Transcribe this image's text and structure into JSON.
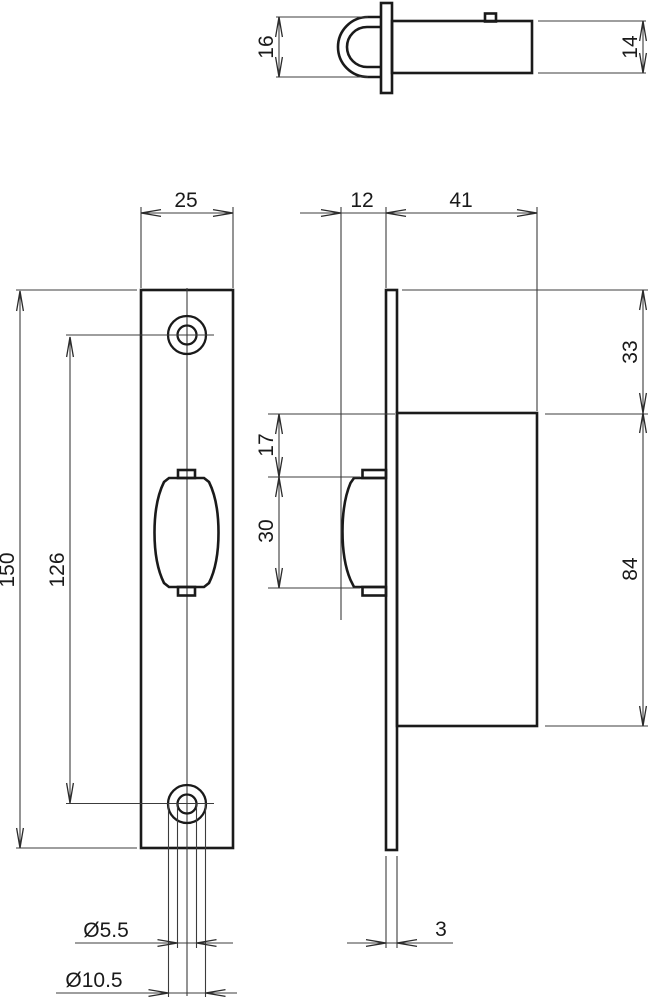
{
  "colors": {
    "background": "#ffffff",
    "outline": "#1a1a1a",
    "thin_line": "#3c3c3c"
  },
  "labels": {
    "top_view": {
      "loop_height": "16",
      "body_height": "14"
    },
    "front_view": {
      "plate_width": "25",
      "plate_height": "150",
      "hole_spacing": "126",
      "hole_dia": "Ø5.5",
      "head_dia": "Ø10.5"
    },
    "side_view": {
      "roller_projection": "12",
      "case_depth": "41",
      "top_offset": "33",
      "roller_top_offset": "17",
      "roller_height": "30",
      "case_height": "84",
      "plate_thickness": "3"
    }
  }
}
